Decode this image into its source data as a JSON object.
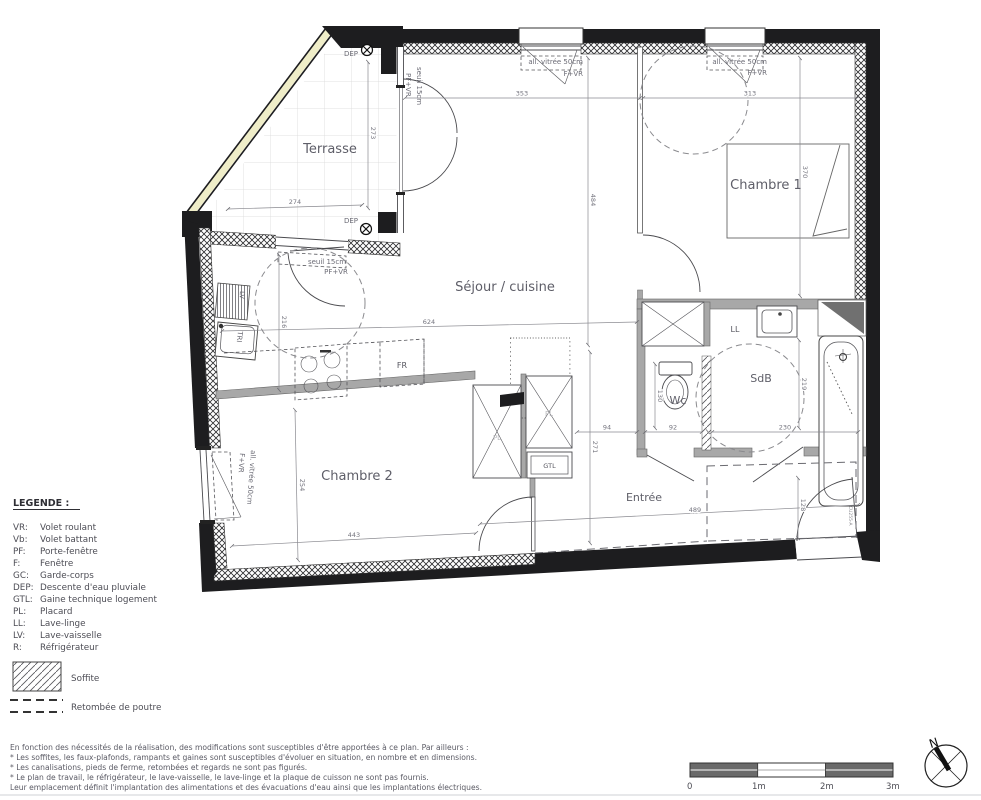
{
  "plan": {
    "rooms": {
      "terrasse": "Terrasse",
      "sejour": "Séjour / cuisine",
      "chambre1": "Chambre 1",
      "chambre2": "Chambre 2",
      "sdb": "SdB",
      "entree": "Entrée",
      "wc": "Wc"
    },
    "fixtures": {
      "ll": "LL",
      "lv": "LV",
      "tri": "TRI",
      "fr": "FR",
      "gtl": "GTL",
      "pl": "PL"
    },
    "annotations": {
      "dep": "DEP",
      "allege_vitree": "all. vitrée 50cm",
      "f_vr": "F+VR",
      "seuil": "seuil 15cm",
      "pf_vr": "PF+VR",
      "door_ref": "CU255-A"
    },
    "dims": {
      "sejour_top": "353",
      "chambre1_top": "313",
      "sejour_height": "484",
      "chambre1_height": "370",
      "terrasse_height": "273",
      "terrasse_width": "274",
      "cuisine_height": "216",
      "sejour_width": "624",
      "chambre2_height": "254",
      "chambre2_width": "443",
      "hall_height": "271",
      "passage": "94",
      "wc_width": "92",
      "sdb_width": "230",
      "sdb_height": "219",
      "wc_depth": "130",
      "porte_width": "128",
      "entree_width": "489"
    }
  },
  "legend": {
    "title": "LEGENDE :",
    "items": [
      {
        "abbr": "VR:",
        "label": "Volet roulant"
      },
      {
        "abbr": "Vb:",
        "label": "Volet battant"
      },
      {
        "abbr": "PF:",
        "label": "Porte-fenêtre"
      },
      {
        "abbr": "F:",
        "label": "Fenêtre"
      },
      {
        "abbr": "GC:",
        "label": "Garde-corps"
      },
      {
        "abbr": "DEP:",
        "label": "Descente d'eau pluviale"
      },
      {
        "abbr": "GTL:",
        "label": "Gaine technique logement"
      },
      {
        "abbr": "PL:",
        "label": "Placard"
      },
      {
        "abbr": "LL:",
        "label": "Lave-linge"
      },
      {
        "abbr": "LV:",
        "label": "Lave-vaisselle"
      },
      {
        "abbr": "R:",
        "label": "Réfrigérateur"
      }
    ],
    "soffite": "Soffite",
    "retombee": "Retombée de poutre"
  },
  "notes": {
    "line1": "En fonction des nécessités de la réalisation, des modifications sont susceptibles d'être apportées à ce plan. Par ailleurs :",
    "line2": "* Les soffites, les faux-plafonds, rampants et gaines sont susceptibles d'évoluer en situation, en nombre et en dimensions.",
    "line3": "* Les canalisations, pieds de ferme, retombées et regards ne sont pas figurés.",
    "line4": "* Le plan de travail, le réfrigérateur, le lave-vaisselle, le lave-linge et la plaque de cuisson ne sont pas fournis.",
    "line5": "Leur emplacement définit l'implantation des alimentations et des évacuations d'eau ainsi que les implantations électriques."
  },
  "scalebar": {
    "t0": "0",
    "t1": "1m",
    "t2": "2m",
    "t3": "3m"
  },
  "compass": {
    "north": "N"
  }
}
